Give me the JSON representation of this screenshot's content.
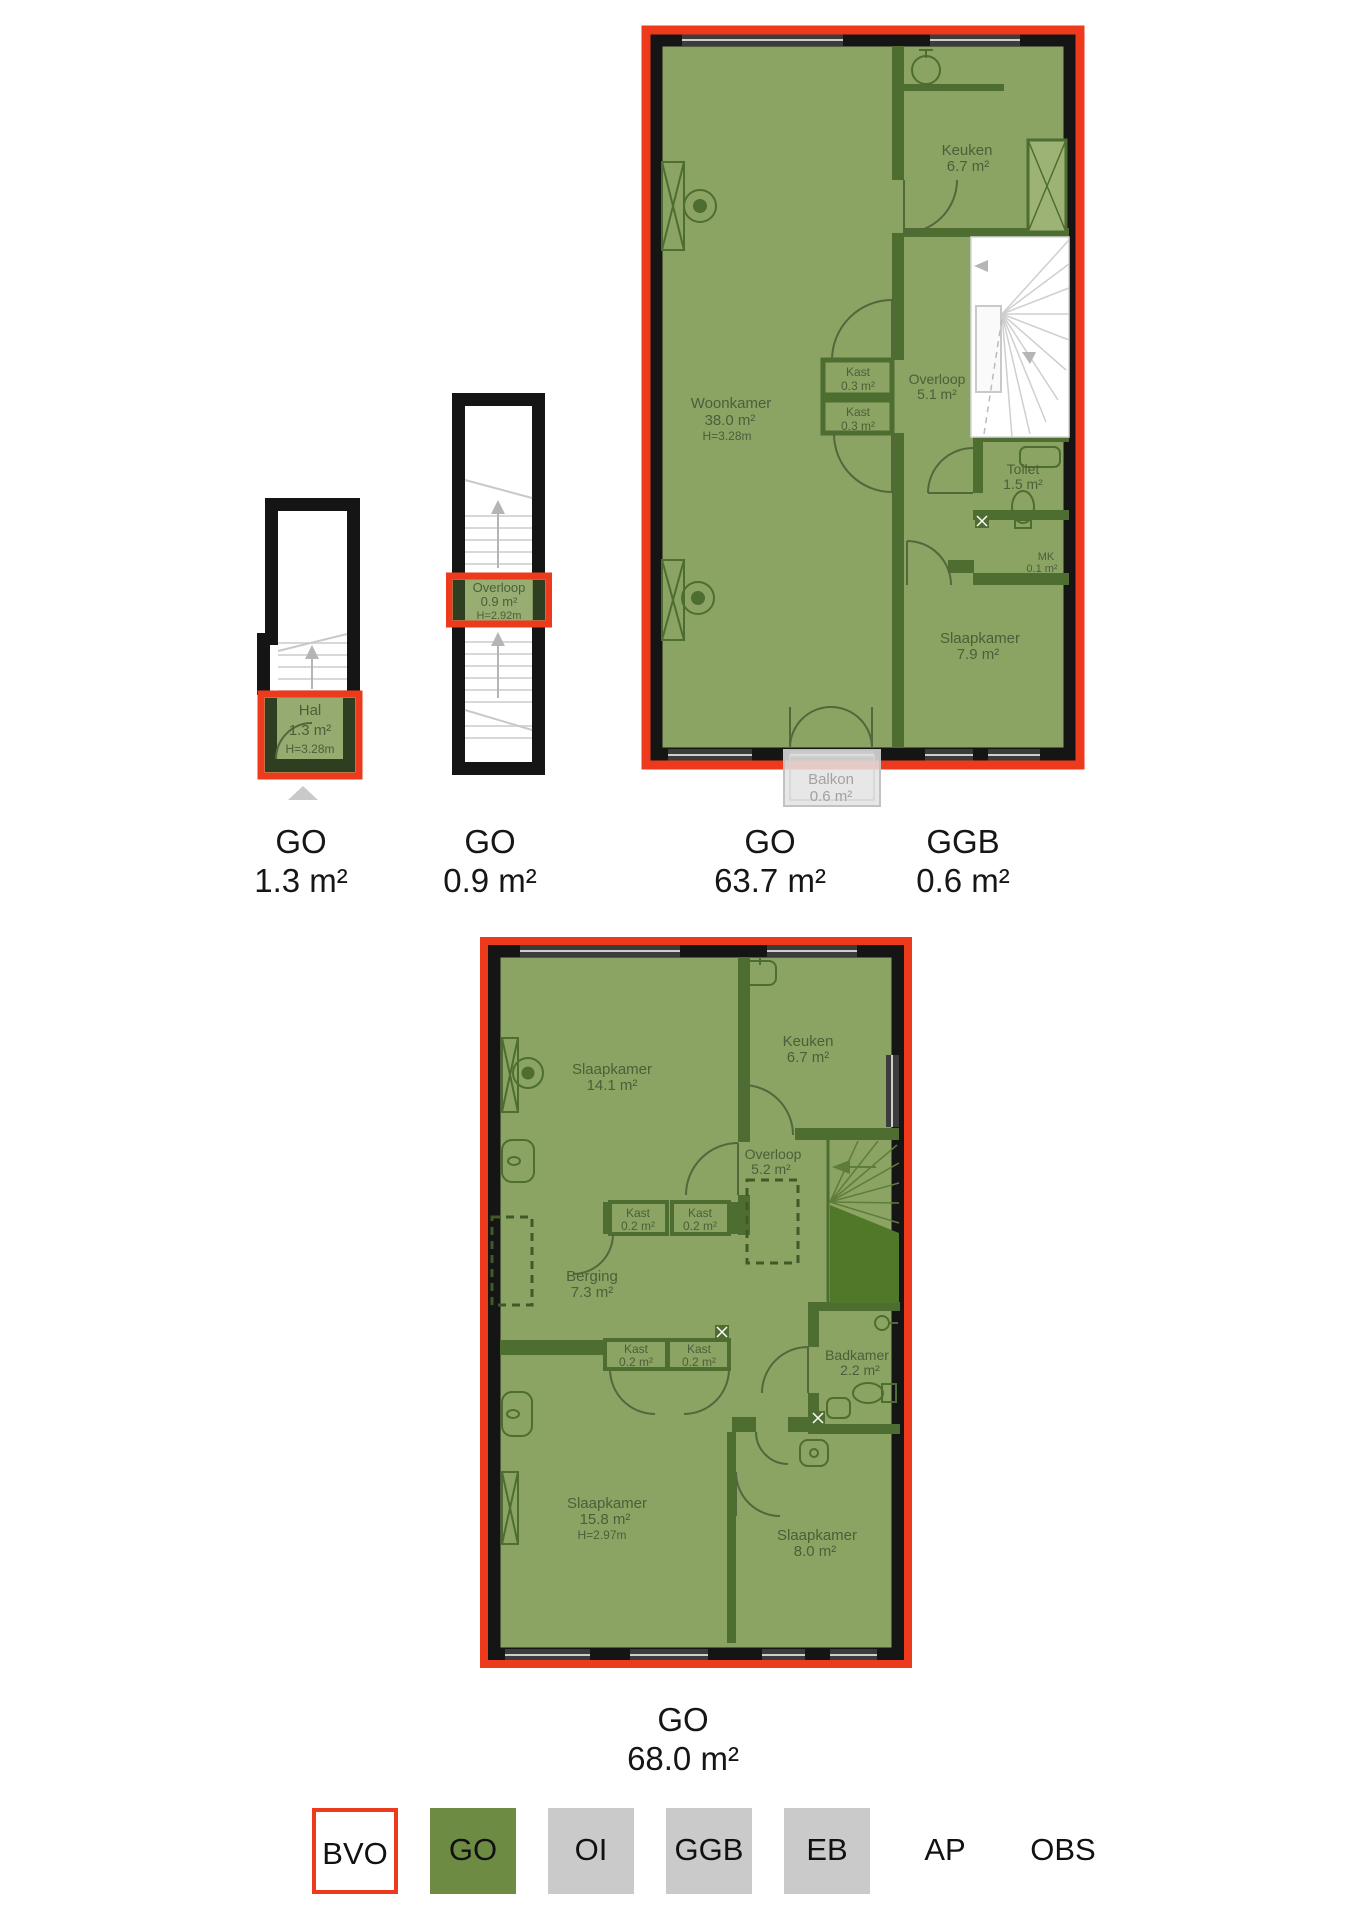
{
  "colors": {
    "bvo_red": "#ee3a1c",
    "legend_green": "#6e8b43",
    "plan_overlay_green": "#8ca463",
    "wall_green": "#4d6d31",
    "understair_green": "#507829",
    "legend_gray": "#cacaca",
    "wall_black": "#151515",
    "window_gray": "#3c3c3c",
    "room_text": "#4c5e3a",
    "balkon_text": "#a2a2a2"
  },
  "plans": {
    "hal_floor": {
      "rooms": {
        "hal": {
          "name": "Hal",
          "area": "1.3 m²",
          "height": "H=3.28m"
        }
      }
    },
    "overloop_floor": {
      "rooms": {
        "overloop": {
          "name": "Overloop",
          "area": "0.9 m²",
          "height": "H=2.92m"
        }
      }
    },
    "first_floor": {
      "rooms": {
        "woonkamer": {
          "name": "Woonkamer",
          "area": "38.0 m²",
          "height": "H=3.28m"
        },
        "keuken": {
          "name": "Keuken",
          "area": "6.7 m²"
        },
        "kast1": {
          "name": "Kast",
          "area": "0.3 m²"
        },
        "kast2": {
          "name": "Kast",
          "area": "0.3 m²"
        },
        "overloop": {
          "name": "Overloop",
          "area": "5.1 m²"
        },
        "toilet": {
          "name": "Toilet",
          "area": "1.5 m²"
        },
        "mk": {
          "name": "MK",
          "area": "0.1 m²"
        },
        "slaapkamer": {
          "name": "Slaapkamer",
          "area": "7.9 m²"
        },
        "balkon": {
          "name": "Balkon",
          "area": "0.6 m²"
        }
      }
    },
    "second_floor": {
      "rooms": {
        "slaapkamer1": {
          "name": "Slaapkamer",
          "area": "14.1 m²"
        },
        "keuken": {
          "name": "Keuken",
          "area": "6.7 m²"
        },
        "overloop": {
          "name": "Overloop",
          "area": "5.2 m²"
        },
        "kast1": {
          "name": "Kast",
          "area": "0.2 m²"
        },
        "kast2": {
          "name": "Kast",
          "area": "0.2 m²"
        },
        "berging": {
          "name": "Berging",
          "area": "7.3 m²"
        },
        "kast3": {
          "name": "Kast",
          "area": "0.2 m²"
        },
        "kast4": {
          "name": "Kast",
          "area": "0.2 m²"
        },
        "badkamer": {
          "name": "Badkamer",
          "area": "2.2 m²"
        },
        "slaapkamer2": {
          "name": "Slaapkamer",
          "area": "15.8 m²",
          "height": "H=2.97m"
        },
        "slaapkamer3": {
          "name": "Slaapkamer",
          "area": "8.0 m²"
        }
      }
    }
  },
  "area_labels": [
    {
      "code": "GO",
      "value": "1.3 m²"
    },
    {
      "code": "GO",
      "value": "0.9 m²"
    },
    {
      "code": "GO",
      "value": "63.7 m²"
    },
    {
      "code": "GGB",
      "value": "0.6 m²"
    },
    {
      "code": "GO",
      "value": "68.0 m²"
    }
  ],
  "legend": {
    "items": [
      {
        "label": "BVO",
        "style": "red-outline"
      },
      {
        "label": "GO",
        "style": "green"
      },
      {
        "label": "OI",
        "style": "gray"
      },
      {
        "label": "GGB",
        "style": "gray"
      },
      {
        "label": "EB",
        "style": "gray"
      },
      {
        "label": "AP",
        "style": "plain"
      },
      {
        "label": "OBS",
        "style": "plain"
      }
    ]
  }
}
